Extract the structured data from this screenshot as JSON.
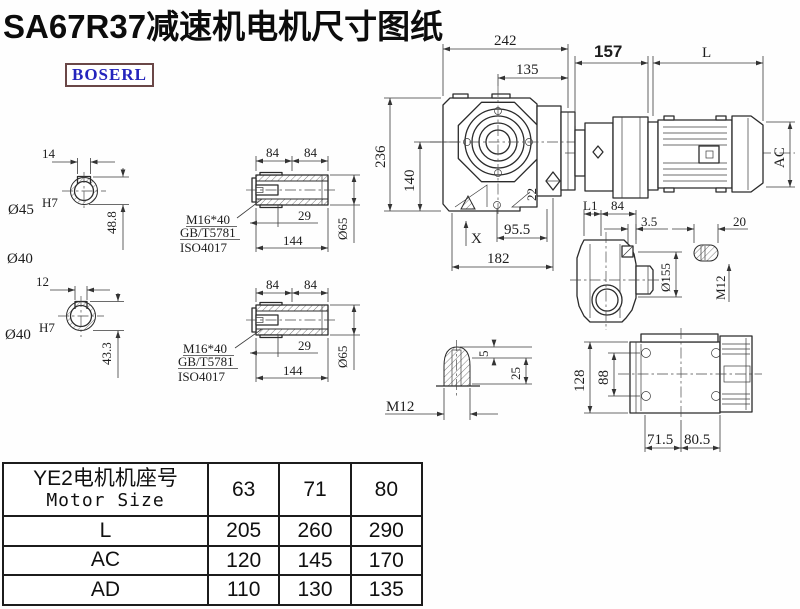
{
  "title": "SA67R37减速机电机尺寸图纸",
  "logo": "BOSERL",
  "colors": {
    "line": "#2b2b2b",
    "title": "#0c0c0c",
    "logo_text": "#2424bd",
    "logo_border": "#6a4747"
  },
  "views": {
    "hollow_shaft_a": {
      "key_width": "14",
      "bore": "Ø45",
      "bore_tol": "H7",
      "height": "48.8",
      "outer_dia": "Ø40"
    },
    "hollow_shaft_b": {
      "key_width": "12",
      "bore": "Ø40",
      "bore_tol": "H7",
      "height": "43.3"
    },
    "bushing_a": {
      "seg1": "84",
      "seg2": "84",
      "thread": "M16*40",
      "standard1": "GB/T5781",
      "standard2": "ISO4017",
      "socket_depth": "29",
      "length": "144",
      "dia": "Ø65"
    },
    "bushing_b": {
      "seg1": "84",
      "seg2": "84",
      "thread": "M16*40",
      "standard1": "GB/T5781",
      "standard2": "ISO4017",
      "socket_depth": "29",
      "length": "144",
      "dia": "Ø65"
    },
    "main": {
      "width": "242",
      "center_to_face": "135",
      "gearbox_to_motor": "157",
      "motor_length": "L",
      "height": "236",
      "axis_to_bottom": "140",
      "foot": "22",
      "motor_dia": "AC",
      "bottom_a": "95.5",
      "bottom_b": "182",
      "x_mark": "X"
    },
    "top_view": {
      "l1": "L1",
      "d84": "84",
      "lip": "3.5",
      "flange_dia": "Ø155",
      "key_len": "20",
      "thread": "M12"
    },
    "shaft_detail": {
      "step": "5",
      "depth": "25",
      "thread": "M12"
    },
    "rear_view": {
      "height": "128",
      "bolt_span": "88",
      "foot_a": "71.5",
      "foot_b": "80.5"
    }
  },
  "table": {
    "header_line1": "YE2电机机座号",
    "header_line2": "Motor Size",
    "sizes": [
      "63",
      "71",
      "80"
    ],
    "rows": [
      {
        "label": "L",
        "values": [
          "205",
          "260",
          "290"
        ]
      },
      {
        "label": "AC",
        "values": [
          "120",
          "145",
          "170"
        ]
      },
      {
        "label": "AD",
        "values": [
          "110",
          "130",
          "135"
        ]
      }
    ]
  }
}
